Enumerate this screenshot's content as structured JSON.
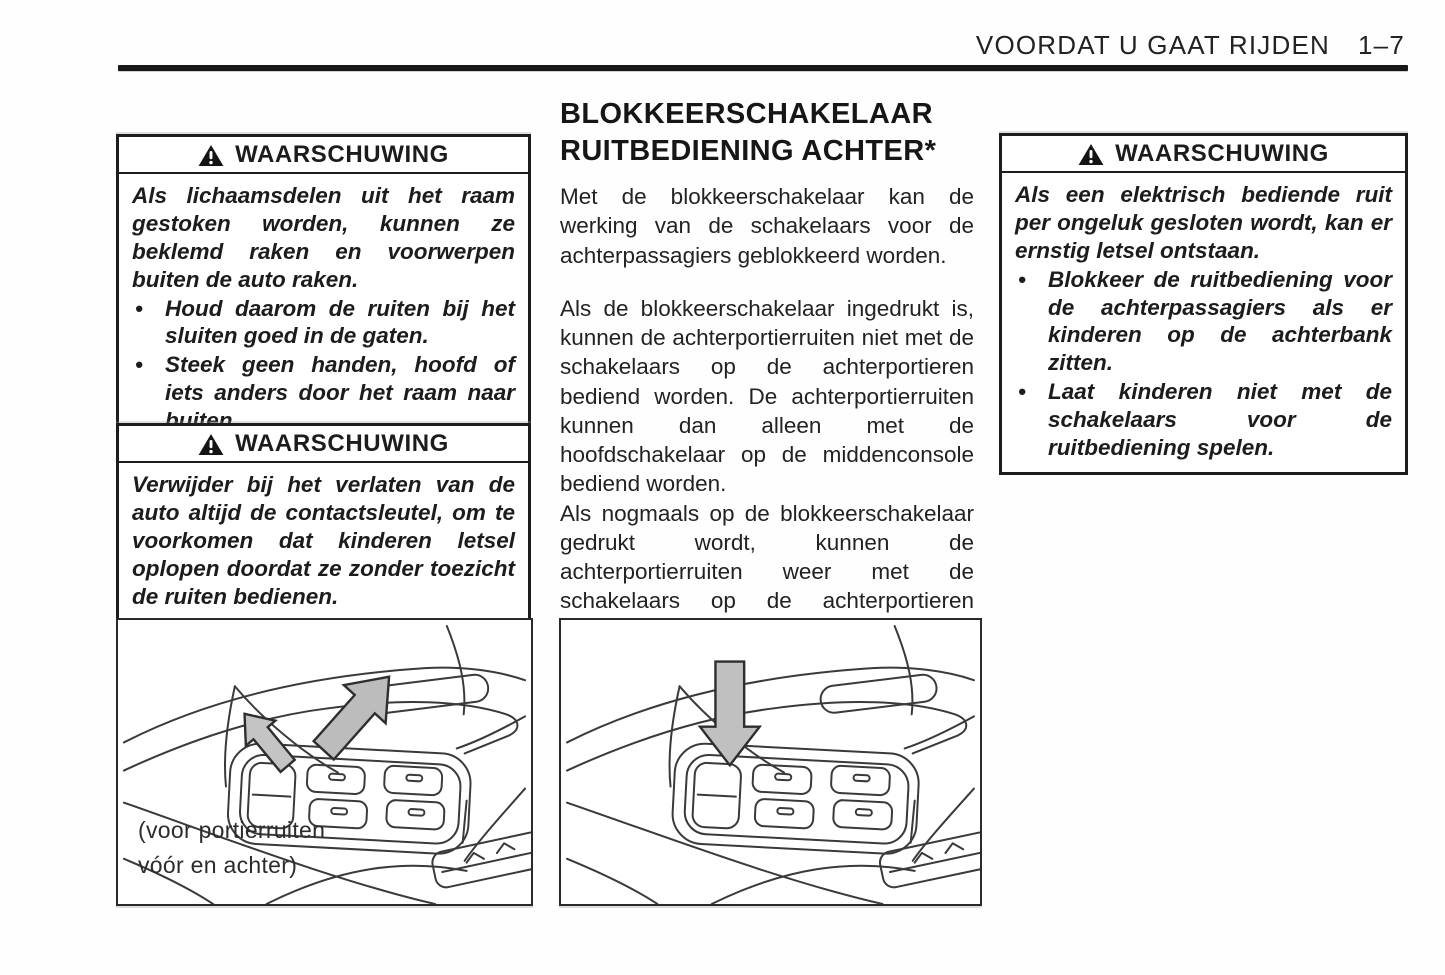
{
  "header": {
    "section_title": "VOORDAT U GAAT RIJDEN",
    "page_number": "1–7"
  },
  "left_column": {
    "warning_top": {
      "title": "WAARSCHUWING",
      "intro": "Als lichaamsdelen uit het raam gestoken worden, kunnen ze beklemd raken en voorwerpen buiten de auto raken.",
      "bullets": [
        "Houd daarom de ruiten bij het sluiten goed in de gaten.",
        "Steek geen handen, hoofd of iets anders door het raam naar buiten."
      ]
    },
    "warning_bottom": {
      "title": "WAARSCHUWING",
      "body": "Verwijder bij het verlaten van de auto altijd de contactsleutel, om te voorkomen dat kinderen letsel oplopen doordat ze zonder toezicht de ruiten bedienen."
    },
    "figure": {
      "caption_line1": "(voor portierruiten",
      "caption_line2": "vóór en achter)"
    }
  },
  "middle_column": {
    "heading_line1": "BLOKKEERSCHAKELAAR",
    "heading_line2": "RUITBEDIENING ACHTER*",
    "paragraphs": [
      "Met de blokkeerschakelaar kan de werking van de schakelaars voor de achterpassagiers geblokkeerd worden.",
      "Als de blokkeerschakelaar ingedrukt is, kunnen de achterportierruiten niet met de schakelaars op de achterportieren bediend worden. De achterportierruiten kunnen dan alleen met de hoofdschakelaar op de middenconsole bediend worden.",
      "Als nogmaals op de blokkeerschakelaar gedrukt wordt, kunnen de achterportierruiten weer met de schakelaars op de achterportieren bediend worden."
    ]
  },
  "right_column": {
    "warning": {
      "title": "WAARSCHUWING",
      "intro": "Als een elektrisch bediende ruit per ongeluk gesloten wordt, kan er ernstig letsel ontstaan.",
      "bullets": [
        "Blokkeer de ruitbediening voor de achterpassagiers als er kinderen op de achterbank zitten.",
        "Laat kinderen niet met de schakelaars voor de ruitbediening spelen."
      ]
    }
  },
  "colors": {
    "ink": "#1c1c1c",
    "arrow_fill": "#bfbfbf",
    "paper": "#fefefe"
  }
}
